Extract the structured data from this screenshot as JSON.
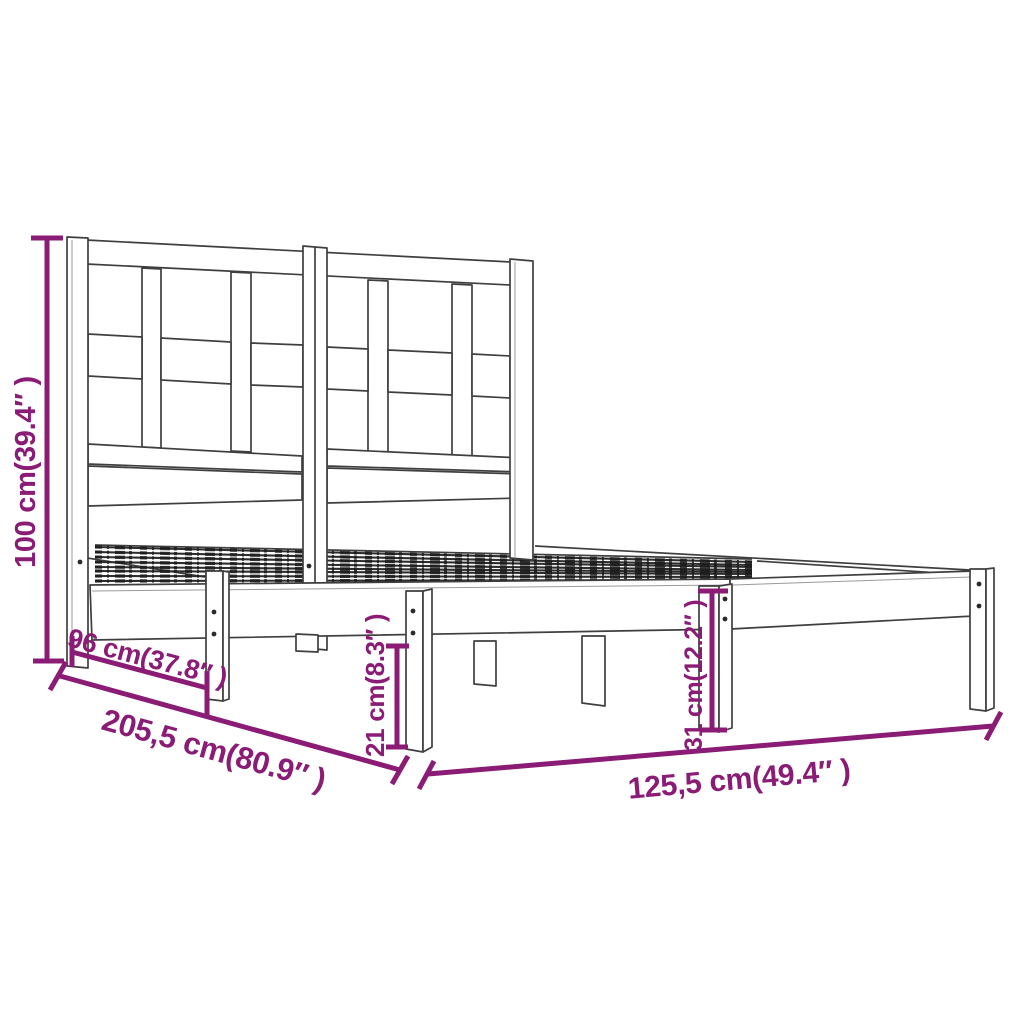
{
  "diagram": {
    "kind": "product-dimension-diagram",
    "subject": "bed-frame-with-headboard",
    "colors": {
      "dimension_accent": "#8B1C76",
      "drawing_line": "#3F3F3F",
      "background": "#FFFFFF"
    },
    "dimensions": [
      {
        "id": "headboard-height",
        "label": "100 cm(39.4″ )",
        "value_cm": "100",
        "value_in": "39.4"
      },
      {
        "id": "headboard-depth",
        "label": "96 cm(37.8″ )",
        "value_cm": "96",
        "value_in": "37.8"
      },
      {
        "id": "total-length",
        "label": "205,5 cm(80.9″ )",
        "value_cm": "205,5",
        "value_in": "80.9"
      },
      {
        "id": "leg-height",
        "label": "21 cm(8.3″ )",
        "value_cm": "21",
        "value_in": "8.3"
      },
      {
        "id": "base-height",
        "label": "31 cm(12.2″ )",
        "value_cm": "31",
        "value_in": "12.2"
      },
      {
        "id": "frame-width",
        "label": "125,5 cm(49.4″ )",
        "value_cm": "125,5",
        "value_in": "49.4"
      }
    ]
  }
}
